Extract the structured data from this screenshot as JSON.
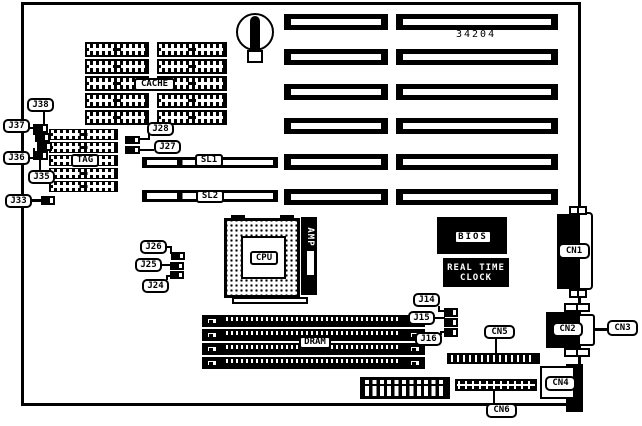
{
  "diagram": {
    "part_number": "34204",
    "components": {
      "cache": "CACHE",
      "tag": "TAG",
      "cpu": "CPU",
      "cpu_socket_brand": "AMP",
      "bios": "BIOS",
      "rtc_line1": "REAL TIME",
      "rtc_line2": "CLOCK",
      "dram": "DRAM"
    },
    "slots": {
      "sl1": "SL1",
      "sl2": "SL2"
    },
    "jumpers": {
      "j38": "J38",
      "j37": "J37",
      "j36": "J36",
      "j35": "J35",
      "j33": "J33",
      "j28": "J28",
      "j27": "J27",
      "j26": "J26",
      "j25": "J25",
      "j24": "J24",
      "j14": "J14",
      "j15": "J15",
      "j16": "J16"
    },
    "connectors": {
      "cn1": "CN1",
      "cn2": "CN2",
      "cn3": "CN3",
      "cn4": "CN4",
      "cn5": "CN5",
      "cn6": "CN6"
    },
    "colors": {
      "ink": "#000000",
      "paper": "#ffffff"
    }
  }
}
